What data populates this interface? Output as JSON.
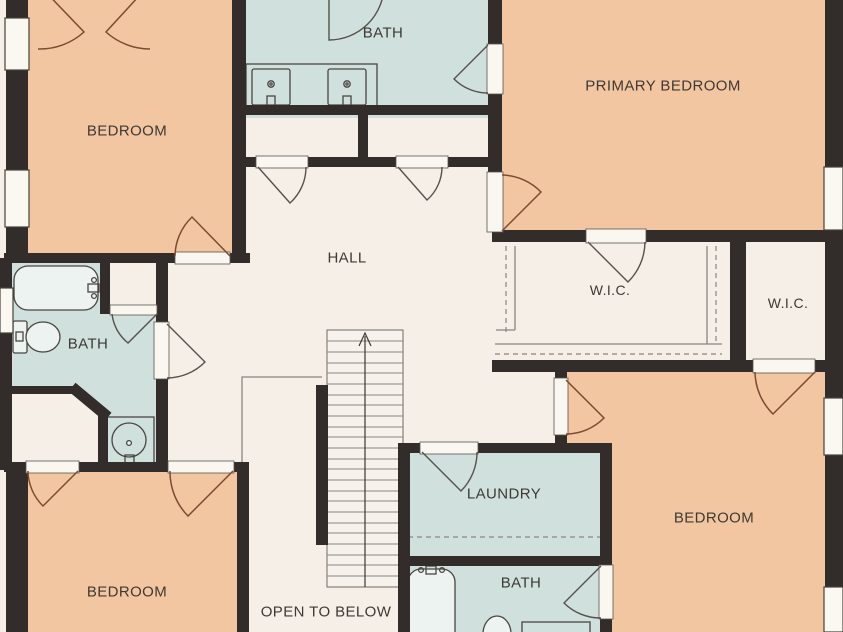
{
  "plan": {
    "title": "Upper floor plan",
    "rooms": [
      {
        "name": "bedroom-top-left",
        "label": "BEDROOM"
      },
      {
        "name": "bath-top",
        "label": "BATH"
      },
      {
        "name": "primary-bedroom",
        "label": "PRIMARY BEDROOM"
      },
      {
        "name": "hall",
        "label": "HALL"
      },
      {
        "name": "wic-large",
        "label": "W.I.C."
      },
      {
        "name": "wic-small",
        "label": "W.I.C."
      },
      {
        "name": "bath-left",
        "label": "BATH"
      },
      {
        "name": "laundry",
        "label": "LAUNDRY"
      },
      {
        "name": "bedroom-bottom-right",
        "label": "BEDROOM"
      },
      {
        "name": "bath-bottom",
        "label": "BATH"
      },
      {
        "name": "bedroom-bottom-left",
        "label": "BEDROOM"
      },
      {
        "name": "open-to-below",
        "label": "OPEN TO BELOW"
      }
    ],
    "fixtures": [
      "bathtub",
      "toilet",
      "vanity-sink",
      "double-vanity-sinks",
      "staircase-up-arrow",
      "closet-shelf-lines",
      "windows",
      "door-swings"
    ],
    "colors": {
      "floor": "#f5efe8",
      "bedroom_fill": "#f2c6a0",
      "wet_room_fill": "#cfe0dd",
      "wall": "#322d2a",
      "label_text": "#3e3933",
      "door_wood": "#7d4b33",
      "door_gray": "#56514b",
      "fixture_line": "#4a4541",
      "fixture_fill": "#edf3f0",
      "thin_line": "#8a857f",
      "opening_fill": "#faf6f0",
      "stairs_fill": "#f7f2ec"
    }
  }
}
